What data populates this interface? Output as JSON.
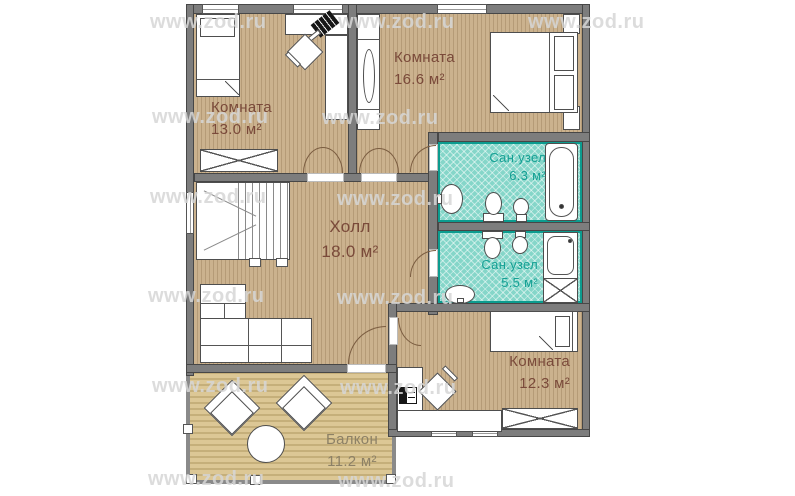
{
  "title": "Floor plan",
  "watermark": {
    "text": "www.zod.ru"
  },
  "rooms": {
    "room13": {
      "label": "Комната",
      "area": "13.0 м²"
    },
    "room166": {
      "label": "Комната",
      "area": "16.6 м²"
    },
    "bath63": {
      "label": "Сан.узел",
      "area": "6.3 м²"
    },
    "bath55": {
      "label": "Сан.узел",
      "area": "5.5 м²"
    },
    "hall": {
      "label": "Холл",
      "area": "18.0 м²"
    },
    "room123": {
      "label": "Комната",
      "area": "12.3 м²"
    },
    "balcony": {
      "label": "Балкон",
      "area": "11.2 м²"
    }
  },
  "colors": {
    "wall": "#7d7d7d",
    "floor_wood": "#c4aa85",
    "floor_balcony": "#d8c491",
    "floor_bath": "#85d6c9",
    "bath_accent": "#0c9c8f",
    "room_label": "#7a4a3a",
    "bath_label": "#15a094",
    "balcony_label": "#8d8166"
  }
}
